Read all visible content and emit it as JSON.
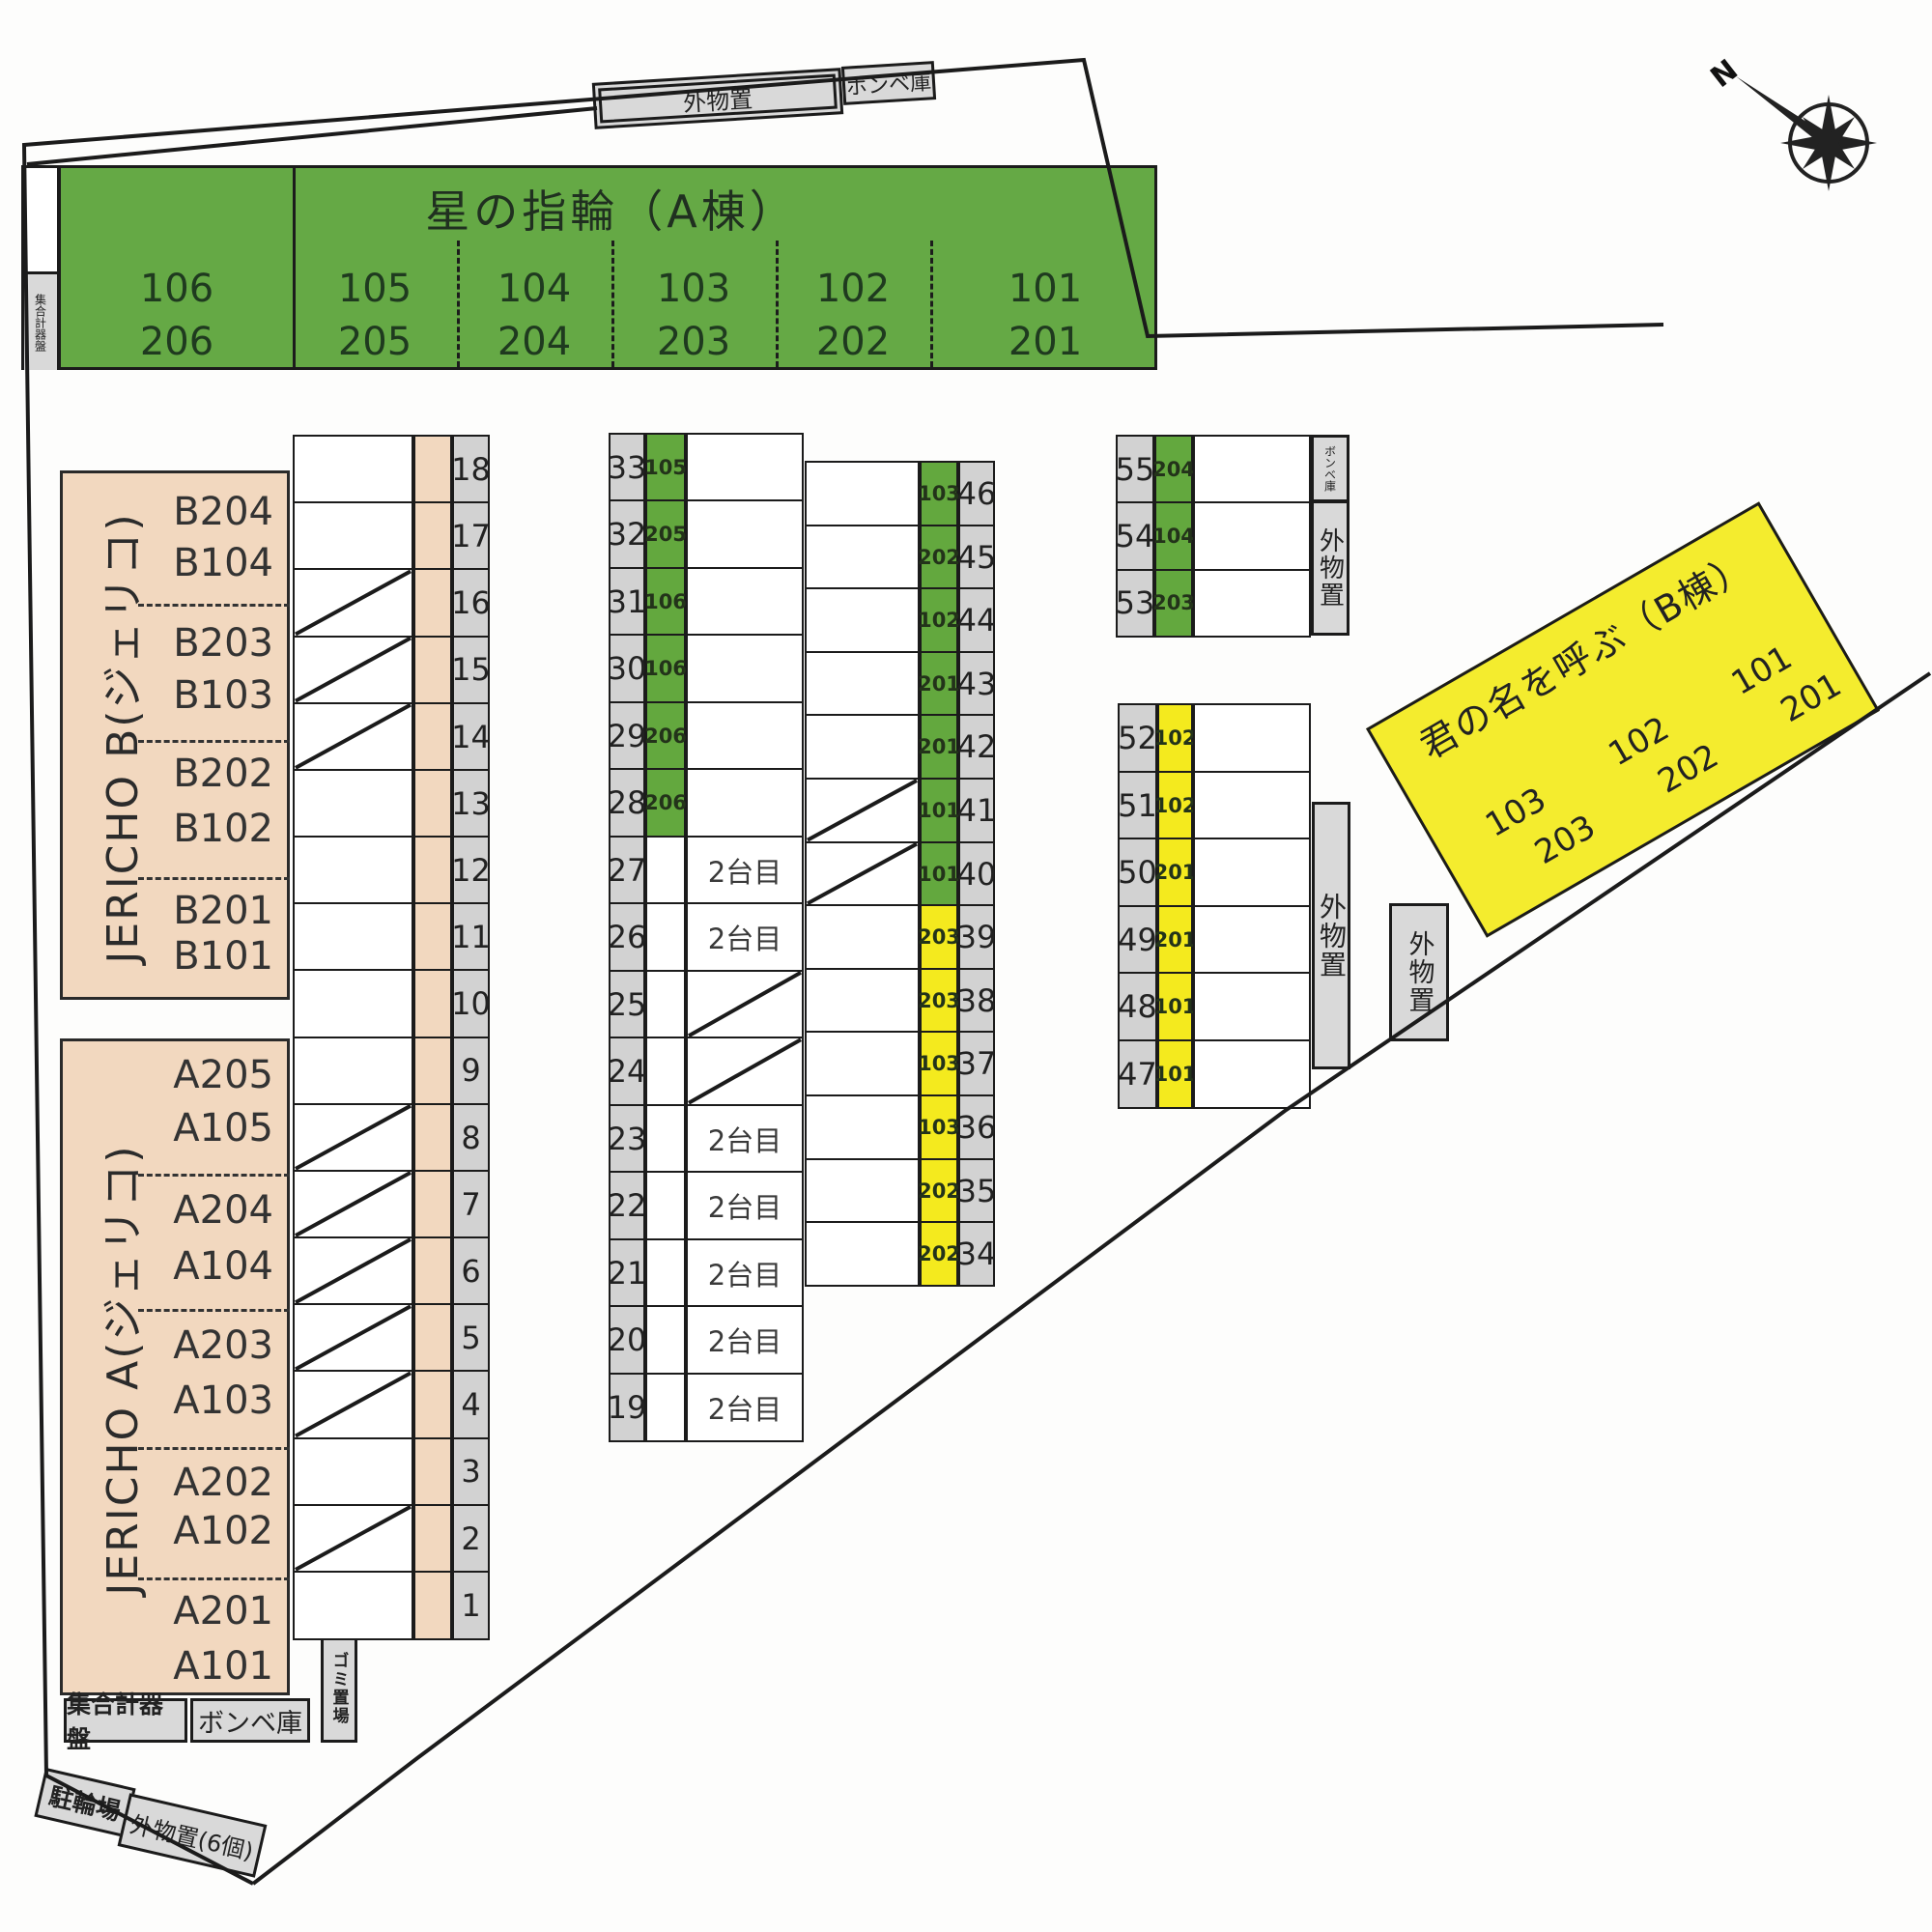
{
  "compass": {
    "north": "N"
  },
  "green_building": {
    "title": "星の指輪（A棟）",
    "meter_panel": "集合計器盤",
    "units": [
      {
        "first": "106",
        "second": "206"
      },
      {
        "first": "105",
        "second": "205"
      },
      {
        "first": "104",
        "second": "204"
      },
      {
        "first": "103",
        "second": "203"
      },
      {
        "first": "102",
        "second": "202"
      },
      {
        "first": "101",
        "second": "201"
      }
    ]
  },
  "jericho_b": {
    "name": "JERICHO B(ジェリコ)",
    "units": [
      "B204",
      "B104",
      "B203",
      "B103",
      "B202",
      "B102",
      "B201",
      "B101"
    ]
  },
  "jericho_a": {
    "name": "JERICHO A(ジェリコ)",
    "units": [
      "A205",
      "A105",
      "A204",
      "A104",
      "A203",
      "A103",
      "A202",
      "A102",
      "A201",
      "A101"
    ]
  },
  "yellow_building": {
    "title": "君の名を呼ぶ（B棟）",
    "columns": [
      {
        "first": "103",
        "second": "203"
      },
      {
        "first": "102",
        "second": "202"
      },
      {
        "first": "101",
        "second": "201"
      }
    ]
  },
  "storage": {
    "top_outdoor": "外物置",
    "top_cylinder": "ボンベ庫",
    "ne_cylinder": "ボンベ庫",
    "ne_outdoor": "外物置",
    "east_outdoor": "外物置",
    "east_outdoor_detached": "外物置",
    "bottom_meter": "集合計器盤",
    "bottom_cylinder": "ボンベ庫",
    "garbage": "ゴミ置場",
    "bicycle": "駐輪場",
    "outdoor6": "外物置(6個)"
  },
  "parking": {
    "west_rows": [
      {
        "no": "18"
      },
      {
        "no": "17"
      },
      {
        "no": "16",
        "diagonal": true
      },
      {
        "no": "15",
        "diagonal": true
      },
      {
        "no": "14",
        "diagonal": true
      },
      {
        "no": "13"
      },
      {
        "no": "12"
      },
      {
        "no": "11"
      },
      {
        "no": "10"
      },
      {
        "no": "9"
      },
      {
        "no": "8",
        "diagonal": true
      },
      {
        "no": "7",
        "diagonal": true
      },
      {
        "no": "6",
        "diagonal": true
      },
      {
        "no": "5",
        "diagonal": true
      },
      {
        "no": "4",
        "diagonal": true
      },
      {
        "no": "3"
      },
      {
        "no": "2",
        "diagonal": true
      },
      {
        "no": "1"
      }
    ],
    "center_left_rows": [
      {
        "no": "33",
        "unit": "105",
        "color": "green"
      },
      {
        "no": "32",
        "unit": "205",
        "color": "green"
      },
      {
        "no": "31",
        "unit": "106",
        "color": "green"
      },
      {
        "no": "30",
        "unit": "106",
        "color": "green"
      },
      {
        "no": "29",
        "unit": "206",
        "color": "green"
      },
      {
        "no": "28",
        "unit": "206",
        "color": "green"
      },
      {
        "no": "27",
        "label": "2台目"
      },
      {
        "no": "26",
        "label": "2台目"
      },
      {
        "no": "25",
        "diagonal": true
      },
      {
        "no": "24",
        "diagonal": true
      },
      {
        "no": "23",
        "label": "2台目"
      },
      {
        "no": "22",
        "label": "2台目"
      },
      {
        "no": "21",
        "label": "2台目"
      },
      {
        "no": "20",
        "label": "2台目"
      },
      {
        "no": "19",
        "label": "2台目"
      }
    ],
    "center_right_rows": [
      {
        "no": "46",
        "unit": "103",
        "color": "green"
      },
      {
        "no": "45",
        "unit": "202",
        "color": "green"
      },
      {
        "no": "44",
        "unit": "102",
        "color": "green"
      },
      {
        "no": "43",
        "unit": "201",
        "color": "green"
      },
      {
        "no": "42",
        "unit": "201",
        "color": "green"
      },
      {
        "no": "41",
        "unit": "101",
        "color": "green",
        "diagonal": true
      },
      {
        "no": "40",
        "unit": "101",
        "color": "green",
        "diagonal": true
      },
      {
        "no": "39",
        "unit": "203",
        "color": "yellow"
      },
      {
        "no": "38",
        "unit": "203",
        "color": "yellow"
      },
      {
        "no": "37",
        "unit": "103",
        "color": "yellow"
      },
      {
        "no": "36",
        "unit": "103",
        "color": "yellow"
      },
      {
        "no": "35",
        "unit": "202",
        "color": "yellow"
      },
      {
        "no": "34",
        "unit": "202",
        "color": "yellow"
      }
    ],
    "northeast_rows": [
      {
        "no": "55",
        "unit": "204",
        "color": "green"
      },
      {
        "no": "54",
        "unit": "104",
        "color": "green"
      },
      {
        "no": "53",
        "unit": "203",
        "color": "green"
      }
    ],
    "east_rows": [
      {
        "no": "52",
        "unit": "102",
        "color": "yellow"
      },
      {
        "no": "51",
        "unit": "102",
        "color": "yellow"
      },
      {
        "no": "50",
        "unit": "201",
        "color": "yellow"
      },
      {
        "no": "49",
        "unit": "201",
        "color": "yellow"
      },
      {
        "no": "48",
        "unit": "101",
        "color": "yellow"
      },
      {
        "no": "47",
        "unit": "101",
        "color": "yellow"
      }
    ]
  },
  "colors": {
    "green": "#63a83e",
    "yellow": "#f4ea1e",
    "peach": "#f2d8bf",
    "gray": "#d2d2d2",
    "line": "#1b1b1b"
  }
}
